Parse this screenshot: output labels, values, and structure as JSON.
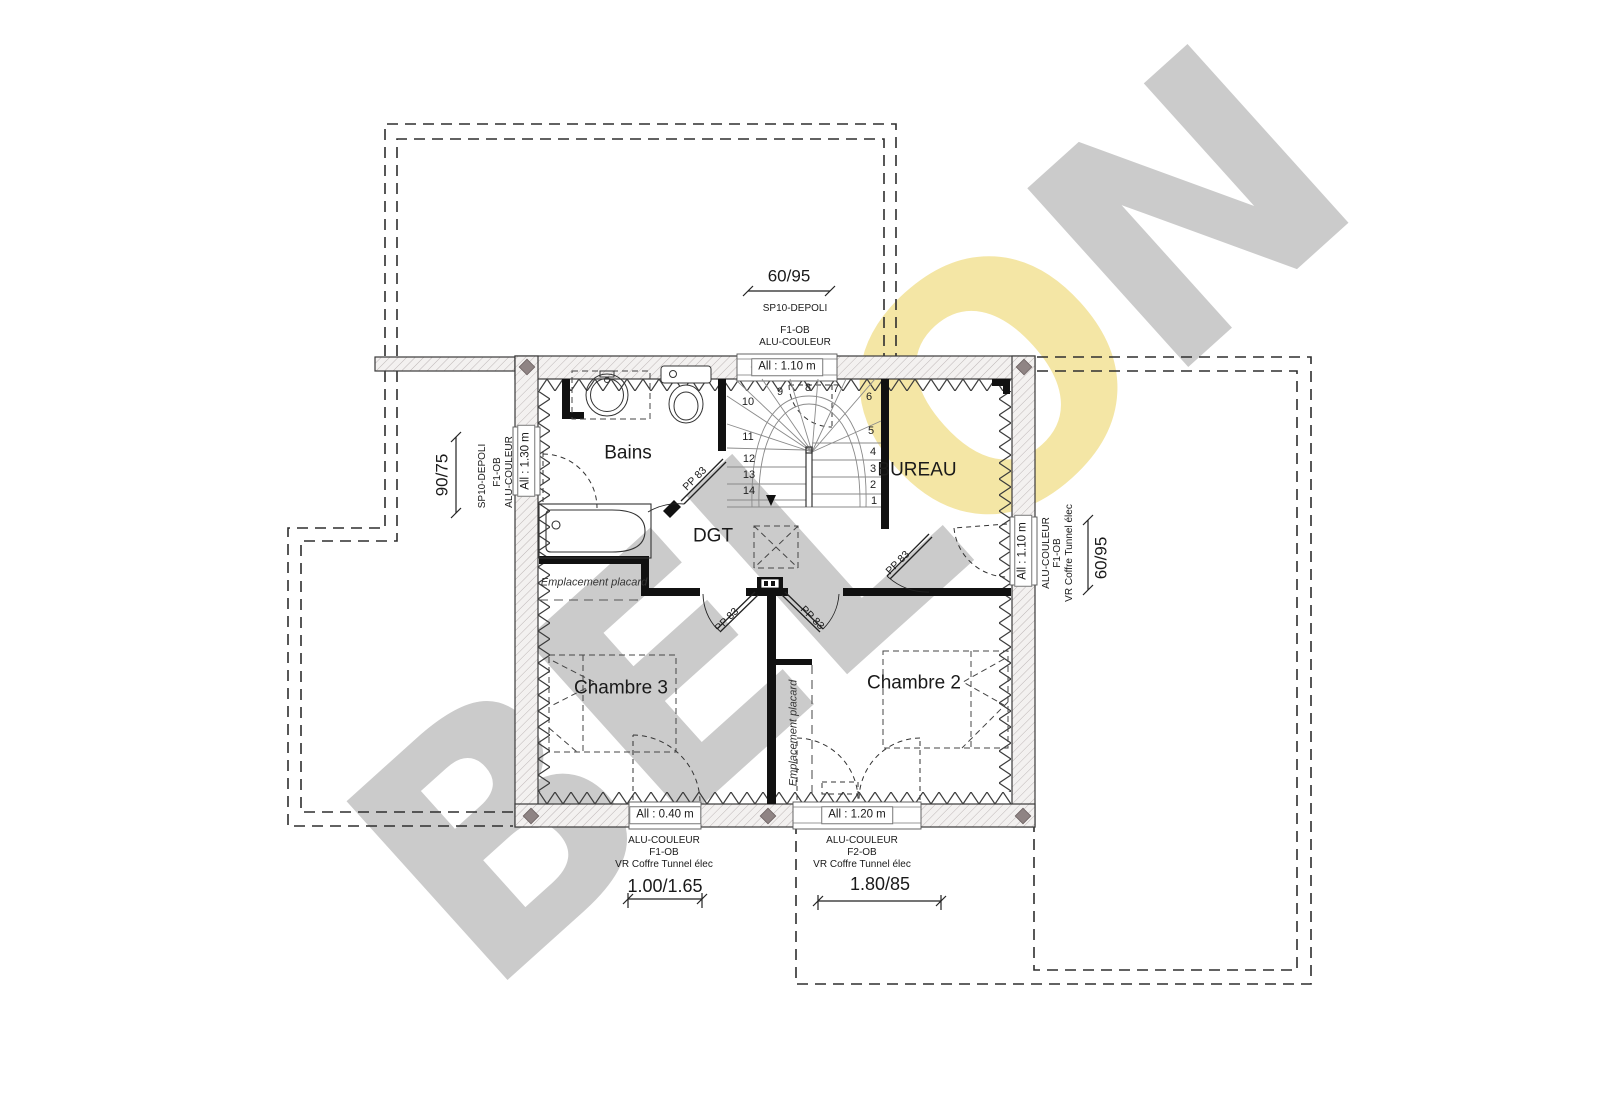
{
  "watermark": {
    "prefix": "BEL",
    "accent": "O",
    "suffix": "N"
  },
  "rooms": {
    "bains": "Bains",
    "bureau": "BUREAU",
    "dgt": "DGT",
    "chambre3": "Chambre 3",
    "chambre2": "Chambre 2"
  },
  "labels": {
    "placard": "Emplacement placard",
    "door": "PP 83"
  },
  "stairs": {
    "numbers": [
      "1",
      "2",
      "3",
      "4",
      "5",
      "6",
      "7",
      "8",
      "9",
      "10",
      "11",
      "12",
      "13",
      "14"
    ]
  },
  "windows": {
    "top": {
      "dim": "60/95",
      "line1": "SP10-DEPOLI",
      "line2": "F1-OB",
      "line3": "ALU-COULEUR",
      "sill": "All : 1.10 m"
    },
    "left": {
      "dim": "90/75",
      "line1": "SP10-DEPOLI",
      "line2": "F1-OB",
      "line3": "ALU-COULEUR",
      "sill": "All : 1.30 m"
    },
    "right": {
      "dim": "60/95",
      "line1": "ALU-COULEUR",
      "line2": "F1-OB",
      "line3": "VR Coffre Tunnel élec",
      "sill": "All : 1.10 m"
    },
    "bottom_left": {
      "dim": "1.00/1.65",
      "line1": "ALU-COULEUR",
      "line2": "F1-OB",
      "line3": "VR Coffre Tunnel élec",
      "sill": "All : 0.40 m"
    },
    "bottom_right": {
      "dim": "1.80/85",
      "line1": "ALU-COULEUR",
      "line2": "F2-OB",
      "line3": "VR Coffre Tunnel élec",
      "sill": "All : 1.20 m"
    }
  },
  "colors": {
    "watermark_gray": "#cbcbcb",
    "watermark_yellow": "#f4e6a5",
    "wall_fill": "#f3f1f0",
    "wall_line": "#3a3a3a",
    "diamond": "#8f8484"
  }
}
